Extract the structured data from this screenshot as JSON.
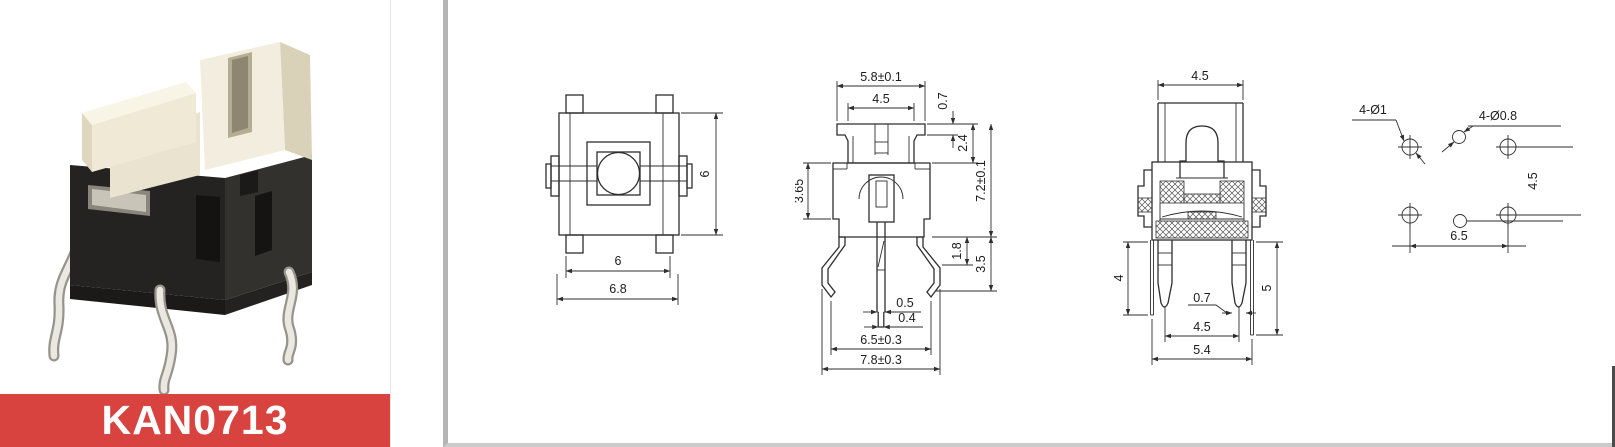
{
  "product": {
    "model": "KAN0713"
  },
  "colors": {
    "banner": "#d8433f",
    "line": "#2e2e2e",
    "panel_border": "#b5b5b5"
  },
  "drawings": {
    "top_view": {
      "dim_height_right": "6",
      "dim_width_inner": "6",
      "dim_width_outer": "6.8"
    },
    "front_view": {
      "dim_flange_width": "5.8±0.1",
      "dim_cap_width": "4.5",
      "dim_flange_thickness": "0.7",
      "dim_cap_height": "2.4",
      "dim_total_height": "7.2±0.1",
      "dim_body_height": "3.65",
      "dim_leg_bend_height": "1.8",
      "dim_leg_height": "3.5",
      "dim_shaft_width": "0.5",
      "dim_shaft_tip_width": "0.4",
      "dim_tip_span": "6.5±0.3",
      "dim_leg_span": "7.8±0.3"
    },
    "side_view": {
      "dim_cap_width": "4.5",
      "dim_left_leg_length": "4",
      "dim_right_leg_length": "5",
      "dim_leg_thickness": "0.7",
      "dim_leg_span": "4.5",
      "dim_body_width": "5.4"
    },
    "pcb_layout": {
      "label_holes_large": "4-Ø1",
      "label_holes_small": "4-Ø0.8",
      "dim_row_pitch": "4.5",
      "dim_col_pitch": "6.5"
    }
  }
}
